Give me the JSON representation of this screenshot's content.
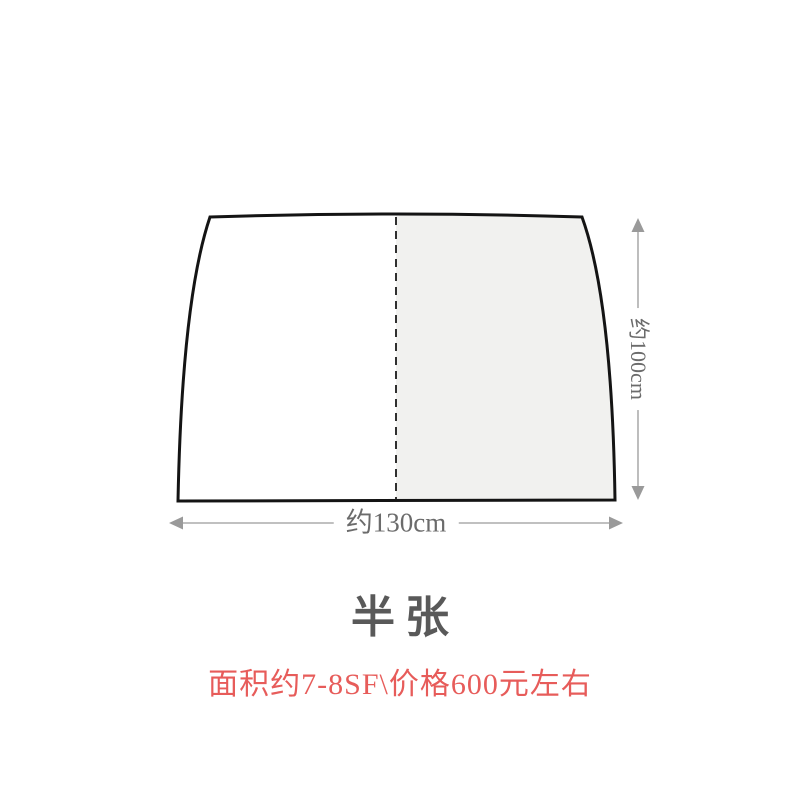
{
  "diagram": {
    "subject": "half-leather-hide-outline",
    "width_label": "约130cm",
    "height_label": "约100cm"
  },
  "caption": {
    "title": "半张",
    "price_note": "面积约7-8SF\\价格600元左右"
  },
  "colors": {
    "background": "#ffffff",
    "hide_outline": "#141414",
    "hide_right_half_fill": "#f1f1ef",
    "fold_dashed_line": "#1a1a1a",
    "dimension_arrow": "#9a9a9a",
    "dimension_label": "#6b6b6b",
    "title_text": "#595959",
    "price_text": "#e75c5a"
  }
}
